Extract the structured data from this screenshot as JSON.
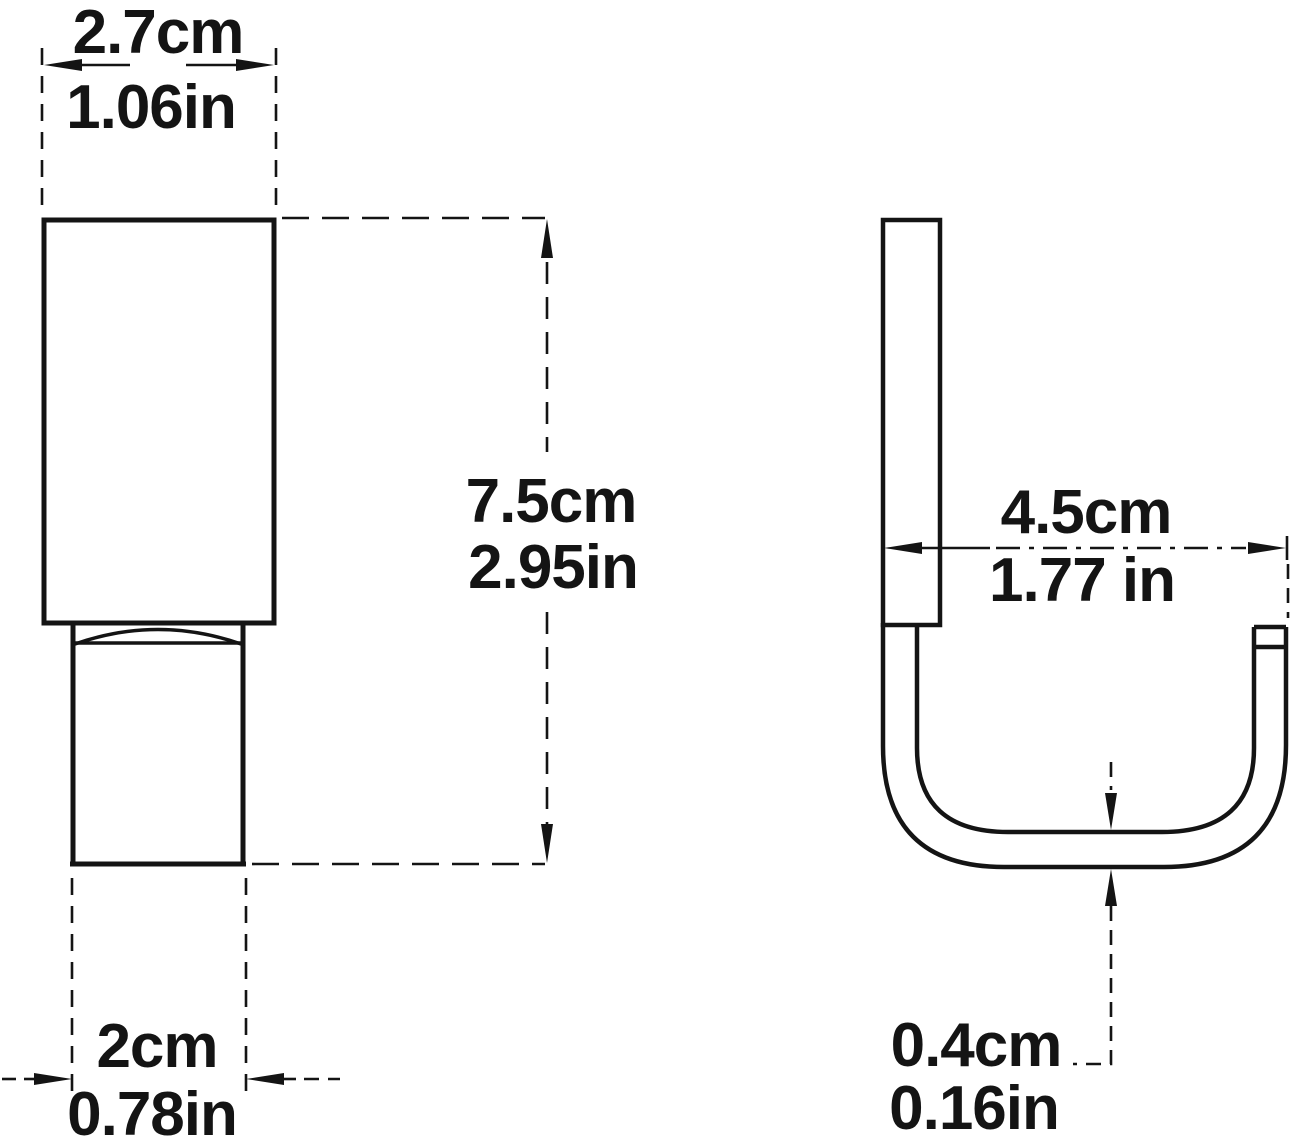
{
  "diagram": {
    "description": "technical dimension drawing of a J-shaped hook, front view and side view",
    "colors": {
      "ink": "#141414",
      "background": "#ffffff"
    },
    "front_view": {
      "top_width": {
        "cm": "2.7cm",
        "in": "1.06in"
      },
      "height": {
        "cm": "7.5cm",
        "in": "2.95in"
      },
      "bottom_width": {
        "cm": "2cm",
        "in": "0.78in"
      }
    },
    "side_view": {
      "depth": {
        "cm": "4.5cm",
        "in": "1.77 in"
      },
      "thickness": {
        "cm": "0.4cm",
        "in": "0.16in"
      }
    }
  }
}
